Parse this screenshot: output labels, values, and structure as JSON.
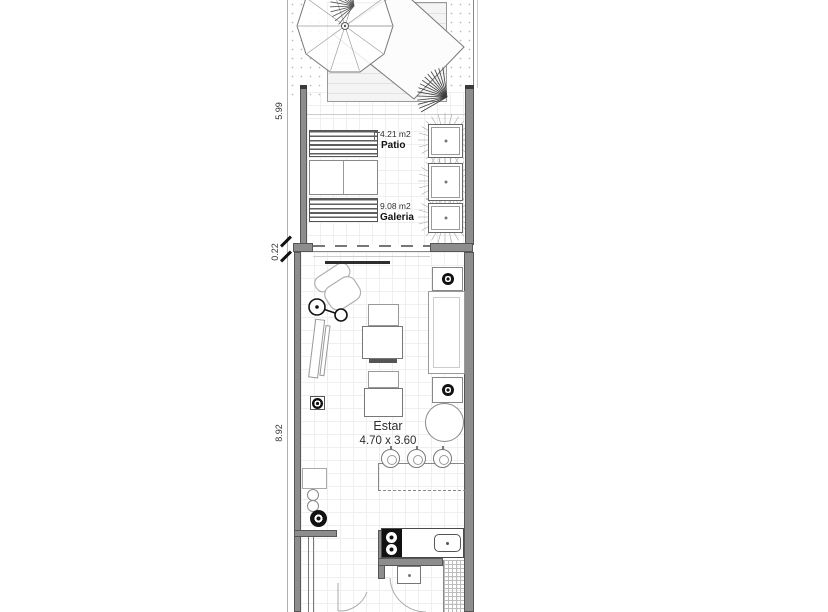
{
  "dimensions": {
    "garden_depth": "5.99",
    "wall_gap": "0.22",
    "interior_depth": "8.92"
  },
  "rooms": [
    {
      "name": "Patio",
      "area": "4.21 m2"
    },
    {
      "name": "Galeria",
      "area": "9.08 m2"
    },
    {
      "name": "Estar",
      "size": "4.70 x 3.60"
    }
  ],
  "colors": {
    "wall": "#8d8d8d",
    "line_dark": "#555555",
    "symbol_black": "#111111"
  }
}
